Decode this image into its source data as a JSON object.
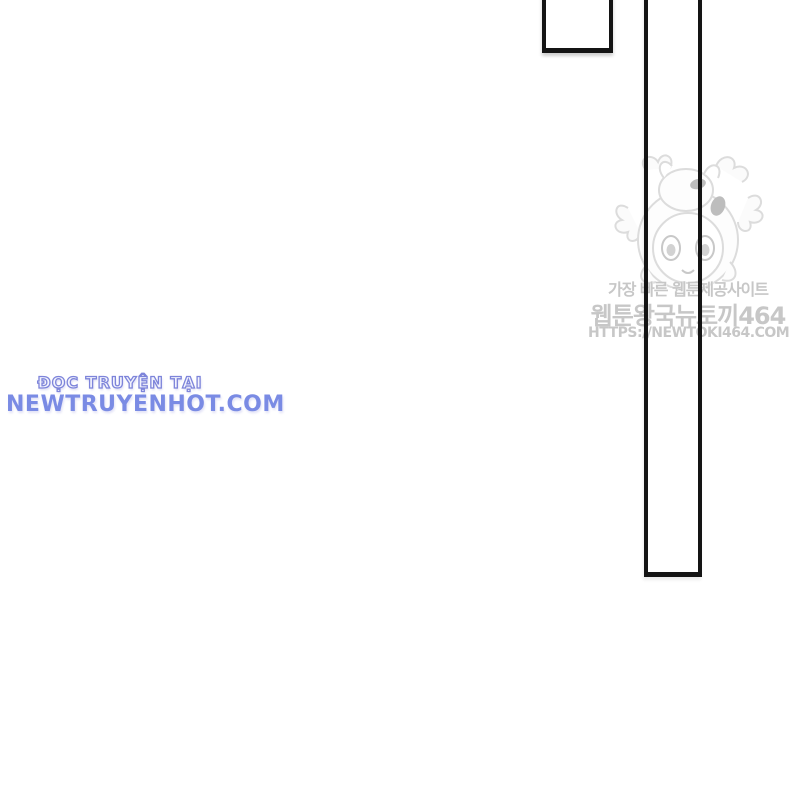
{
  "page": {
    "background_color": "#ffffff",
    "panel_border_color": "#141414",
    "description": "Mostly blank webtoon/comic page with two partial panel borders, an aggregator watermark and a translator-site credit"
  },
  "watermark": {
    "tagline_korean": "가장 빠른 웹툰제공사이트",
    "site_name_korean": "웹툰왕국뉴토끼464",
    "site_url": "HTTPS://NEWTOKI464.COM",
    "text_color": "#c7c7c7",
    "illustration": "chibi-girl-with-bunny-hood",
    "illustration_line_color": "#d9d9d9"
  },
  "translator_credit": {
    "prefix": "ĐỌC TRUYỆN TẠI",
    "site": "NEWTRUYENHOT.COM",
    "accent_color": "#7a8be4"
  }
}
